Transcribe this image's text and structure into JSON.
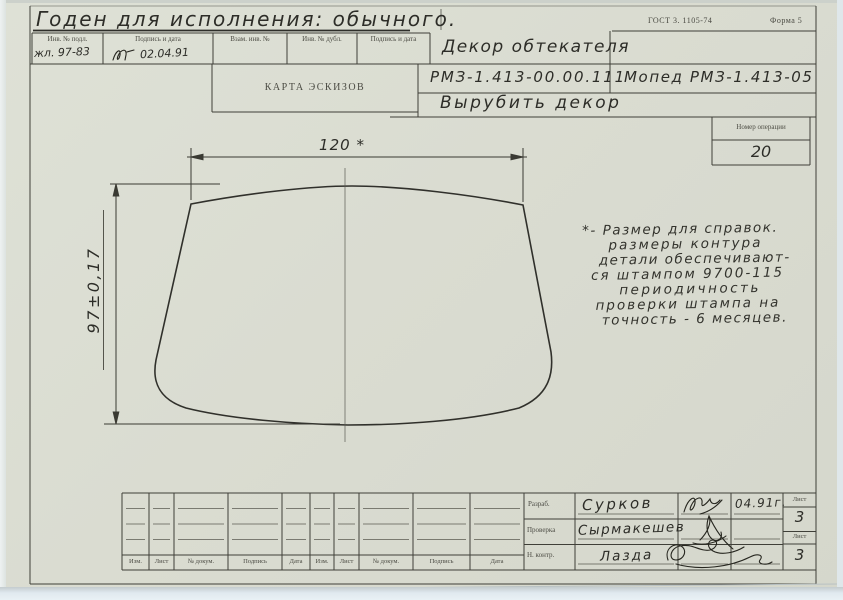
{
  "stamp": {
    "gost": "ГОСТ 3. 1105-74",
    "forma": "Форма 5"
  },
  "approval_note": "Годен для исполнения: обычного.",
  "inv_table": {
    "headers": [
      "Инв. № подл.",
      "Подпись и дата",
      "Взам. инв. №",
      "Инв. № дубл.",
      "Подпись и дата"
    ],
    "inv_number": "жл. 97-83",
    "date": "02.04.91"
  },
  "header": {
    "doc_type": "КАРТА ЭСКИЗОВ",
    "part_name": "Декор обтекателя",
    "doc_number": "РМЗ-1.413-00.00.111",
    "product": "Мопед РМЗ-1.413-05",
    "operation_name": "Вырубить декор",
    "operation_label": "Номер операции",
    "operation_number": "20"
  },
  "drawing": {
    "width_dim": "120 *",
    "height_dim": "97±0,17",
    "note_lines": [
      "*- Размер для справок.",
      "размеры контура",
      "детали обеспечивают-",
      "ся штампом 9700-115",
      "периодичность",
      "проверки штампа на",
      "точность - 6 месяцев."
    ]
  },
  "title_block": {
    "change_headers": [
      "Изм.",
      "Лист",
      "№ докум.",
      "Подпись",
      "Дата",
      "Изм.",
      "Лист",
      "№ докум.",
      "Подпись",
      "Дата"
    ],
    "rows": [
      {
        "role": "Разраб.",
        "name": "Сурков",
        "date": "04.91г."
      },
      {
        "role": "Проверка",
        "name": "Сырмакешев",
        "date": ""
      },
      {
        "role": "Н. контр.",
        "name": "Лазда",
        "date": ""
      }
    ],
    "sheet_label": "Лист",
    "sheet_top": "3",
    "sheet_bottom": "3"
  }
}
